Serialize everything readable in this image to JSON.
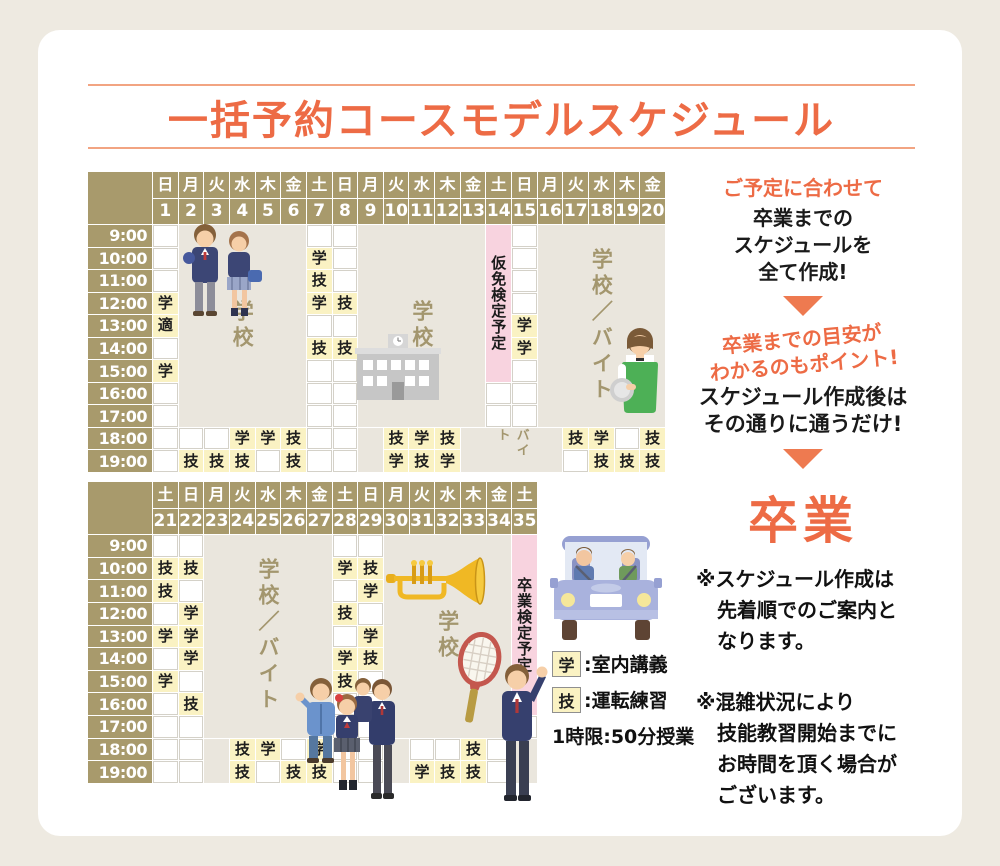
{
  "title": "一括予約コースモデルスケジュール",
  "colors": {
    "accent_orange": "#ed6b45",
    "header_brown": "#a89a6c",
    "cell_yellow": "#faf2c3",
    "block_beige": "#eae6dd",
    "exam_pink": "#f8d3df",
    "page_bg": "#eeeae1"
  },
  "illustrations": [
    "students-pair-illustration",
    "school-building-illustration",
    "waitress-illustration",
    "trumpet-illustration",
    "worker-illustration",
    "three-students-illustration",
    "tennis-racket-illustration",
    "suit-man-illustration",
    "driving-car-illustration"
  ],
  "table1": {
    "days": [
      [
        "日",
        "1"
      ],
      [
        "月",
        "2"
      ],
      [
        "火",
        "3"
      ],
      [
        "水",
        "4"
      ],
      [
        "木",
        "5"
      ],
      [
        "金",
        "6"
      ],
      [
        "土",
        "7"
      ],
      [
        "日",
        "8"
      ],
      [
        "月",
        "9"
      ],
      [
        "火",
        "10"
      ],
      [
        "水",
        "11"
      ],
      [
        "木",
        "12"
      ],
      [
        "金",
        "13"
      ],
      [
        "土",
        "14"
      ],
      [
        "日",
        "15"
      ],
      [
        "月",
        "16"
      ],
      [
        "火",
        "17"
      ],
      [
        "水",
        "18"
      ],
      [
        "木",
        "19"
      ],
      [
        "金",
        "20"
      ]
    ],
    "times": [
      "9:00",
      "10:00",
      "11:00",
      "12:00",
      "13:00",
      "14:00",
      "15:00",
      "16:00",
      "17:00",
      "18:00",
      "19:00"
    ],
    "blocks": [
      {
        "c": 2,
        "cs": 5,
        "r": 1,
        "rs": 9,
        "type": "beige",
        "label": "学校",
        "cls": ""
      },
      {
        "c": 9,
        "cs": 5,
        "r": 1,
        "rs": 9,
        "type": "beige",
        "label": "学校",
        "cls": ""
      },
      {
        "c": 9,
        "cs": 1,
        "r": 10,
        "rs": 2,
        "type": "beige",
        "label": "",
        "cls": ""
      },
      {
        "c": 13,
        "cs": 4,
        "r": 10,
        "rs": 2,
        "type": "beige",
        "label": "バイト",
        "cls": "small"
      },
      {
        "c": 14,
        "cs": 1,
        "r": 1,
        "rs": 7,
        "type": "pink",
        "label": "仮免検定予定",
        "cls": ""
      },
      {
        "c": 16,
        "cs": 5,
        "r": 1,
        "rs": 9,
        "type": "beige",
        "label": "学校／バイト",
        "cls": ""
      }
    ],
    "cells": [
      [
        1,
        4,
        "学"
      ],
      [
        1,
        5,
        "適"
      ],
      [
        1,
        7,
        "学"
      ],
      [
        2,
        11,
        "技"
      ],
      [
        3,
        11,
        "技"
      ],
      [
        4,
        10,
        "学"
      ],
      [
        4,
        11,
        "技"
      ],
      [
        5,
        10,
        "学"
      ],
      [
        6,
        10,
        "技"
      ],
      [
        6,
        11,
        "技"
      ],
      [
        7,
        2,
        "学"
      ],
      [
        7,
        3,
        "技"
      ],
      [
        7,
        4,
        "学"
      ],
      [
        7,
        6,
        "技"
      ],
      [
        8,
        4,
        "技"
      ],
      [
        8,
        6,
        "技"
      ],
      [
        10,
        10,
        "技"
      ],
      [
        10,
        11,
        "学"
      ],
      [
        11,
        10,
        "学"
      ],
      [
        11,
        11,
        "技"
      ],
      [
        12,
        10,
        "技"
      ],
      [
        12,
        11,
        "学"
      ],
      [
        15,
        5,
        "学"
      ],
      [
        15,
        6,
        "学"
      ],
      [
        17,
        10,
        "技"
      ],
      [
        18,
        10,
        "学"
      ],
      [
        18,
        11,
        "技"
      ],
      [
        19,
        11,
        "技"
      ],
      [
        20,
        10,
        "技"
      ],
      [
        20,
        11,
        "技"
      ]
    ]
  },
  "table2": {
    "days": [
      [
        "土",
        "21"
      ],
      [
        "日",
        "22"
      ],
      [
        "月",
        "23"
      ],
      [
        "火",
        "24"
      ],
      [
        "水",
        "25"
      ],
      [
        "木",
        "26"
      ],
      [
        "金",
        "27"
      ],
      [
        "土",
        "28"
      ],
      [
        "日",
        "29"
      ],
      [
        "月",
        "30"
      ],
      [
        "火",
        "31"
      ],
      [
        "水",
        "32"
      ],
      [
        "木",
        "33"
      ],
      [
        "金",
        "34"
      ],
      [
        "土",
        "35"
      ]
    ],
    "times": [
      "9:00",
      "10:00",
      "11:00",
      "12:00",
      "13:00",
      "14:00",
      "15:00",
      "16:00",
      "17:00",
      "18:00",
      "19:00"
    ],
    "blocks": [
      {
        "c": 3,
        "cs": 5,
        "r": 1,
        "rs": 9,
        "type": "beige",
        "label": "学校／バイト",
        "cls": ""
      },
      {
        "c": 3,
        "cs": 1,
        "r": 10,
        "rs": 2,
        "type": "beige",
        "label": "",
        "cls": ""
      },
      {
        "c": 10,
        "cs": 5,
        "r": 1,
        "rs": 9,
        "type": "beige",
        "label": "学校",
        "cls": ""
      },
      {
        "c": 10,
        "cs": 1,
        "r": 10,
        "rs": 2,
        "type": "beige",
        "label": "",
        "cls": ""
      },
      {
        "c": 15,
        "cs": 1,
        "r": 1,
        "rs": 8,
        "type": "pink",
        "label": "卒業検定予定",
        "cls": ""
      },
      {
        "c": 15,
        "cs": 1,
        "r": 10,
        "rs": 2,
        "type": "beige",
        "label": "",
        "cls": ""
      }
    ],
    "cells": [
      [
        1,
        2,
        "技"
      ],
      [
        1,
        3,
        "技"
      ],
      [
        1,
        5,
        "学"
      ],
      [
        1,
        7,
        "学"
      ],
      [
        2,
        2,
        "技"
      ],
      [
        2,
        4,
        "学"
      ],
      [
        2,
        5,
        "学"
      ],
      [
        2,
        6,
        "学"
      ],
      [
        2,
        8,
        "技"
      ],
      [
        4,
        10,
        "技"
      ],
      [
        4,
        11,
        "技"
      ],
      [
        5,
        10,
        "学"
      ],
      [
        6,
        11,
        "技"
      ],
      [
        7,
        10,
        "学"
      ],
      [
        7,
        11,
        "技"
      ],
      [
        8,
        2,
        "学"
      ],
      [
        8,
        4,
        "技"
      ],
      [
        8,
        6,
        "学"
      ],
      [
        8,
        7,
        "技"
      ],
      [
        9,
        2,
        "技"
      ],
      [
        9,
        3,
        "学"
      ],
      [
        9,
        5,
        "学"
      ],
      [
        9,
        6,
        "技"
      ],
      [
        11,
        11,
        "学"
      ],
      [
        12,
        11,
        "技"
      ],
      [
        13,
        10,
        "技"
      ],
      [
        13,
        11,
        "技"
      ]
    ]
  },
  "legend": {
    "gaku_mark": "学",
    "gaku_label": ":室内講義",
    "gi_mark": "技",
    "gi_label": ":運転練習",
    "note": "1時限:50分授業"
  },
  "aside": {
    "lead_orange": "ご予定に合わせて",
    "lead_black": "卒業までの\nスケジュールを\n全て作成!",
    "point_orange": "卒業までの目安が\nわかるのもポイント!",
    "after_black": "スケジュール作成後は\nその通りに通うだけ!",
    "goal": "卒業",
    "note1": "※スケジュール作成は\n先着順でのご案内と\nなります。",
    "note2": "※混雑状況により\n技能教習開始までに\nお時間を頂く場合が\nございます。"
  }
}
